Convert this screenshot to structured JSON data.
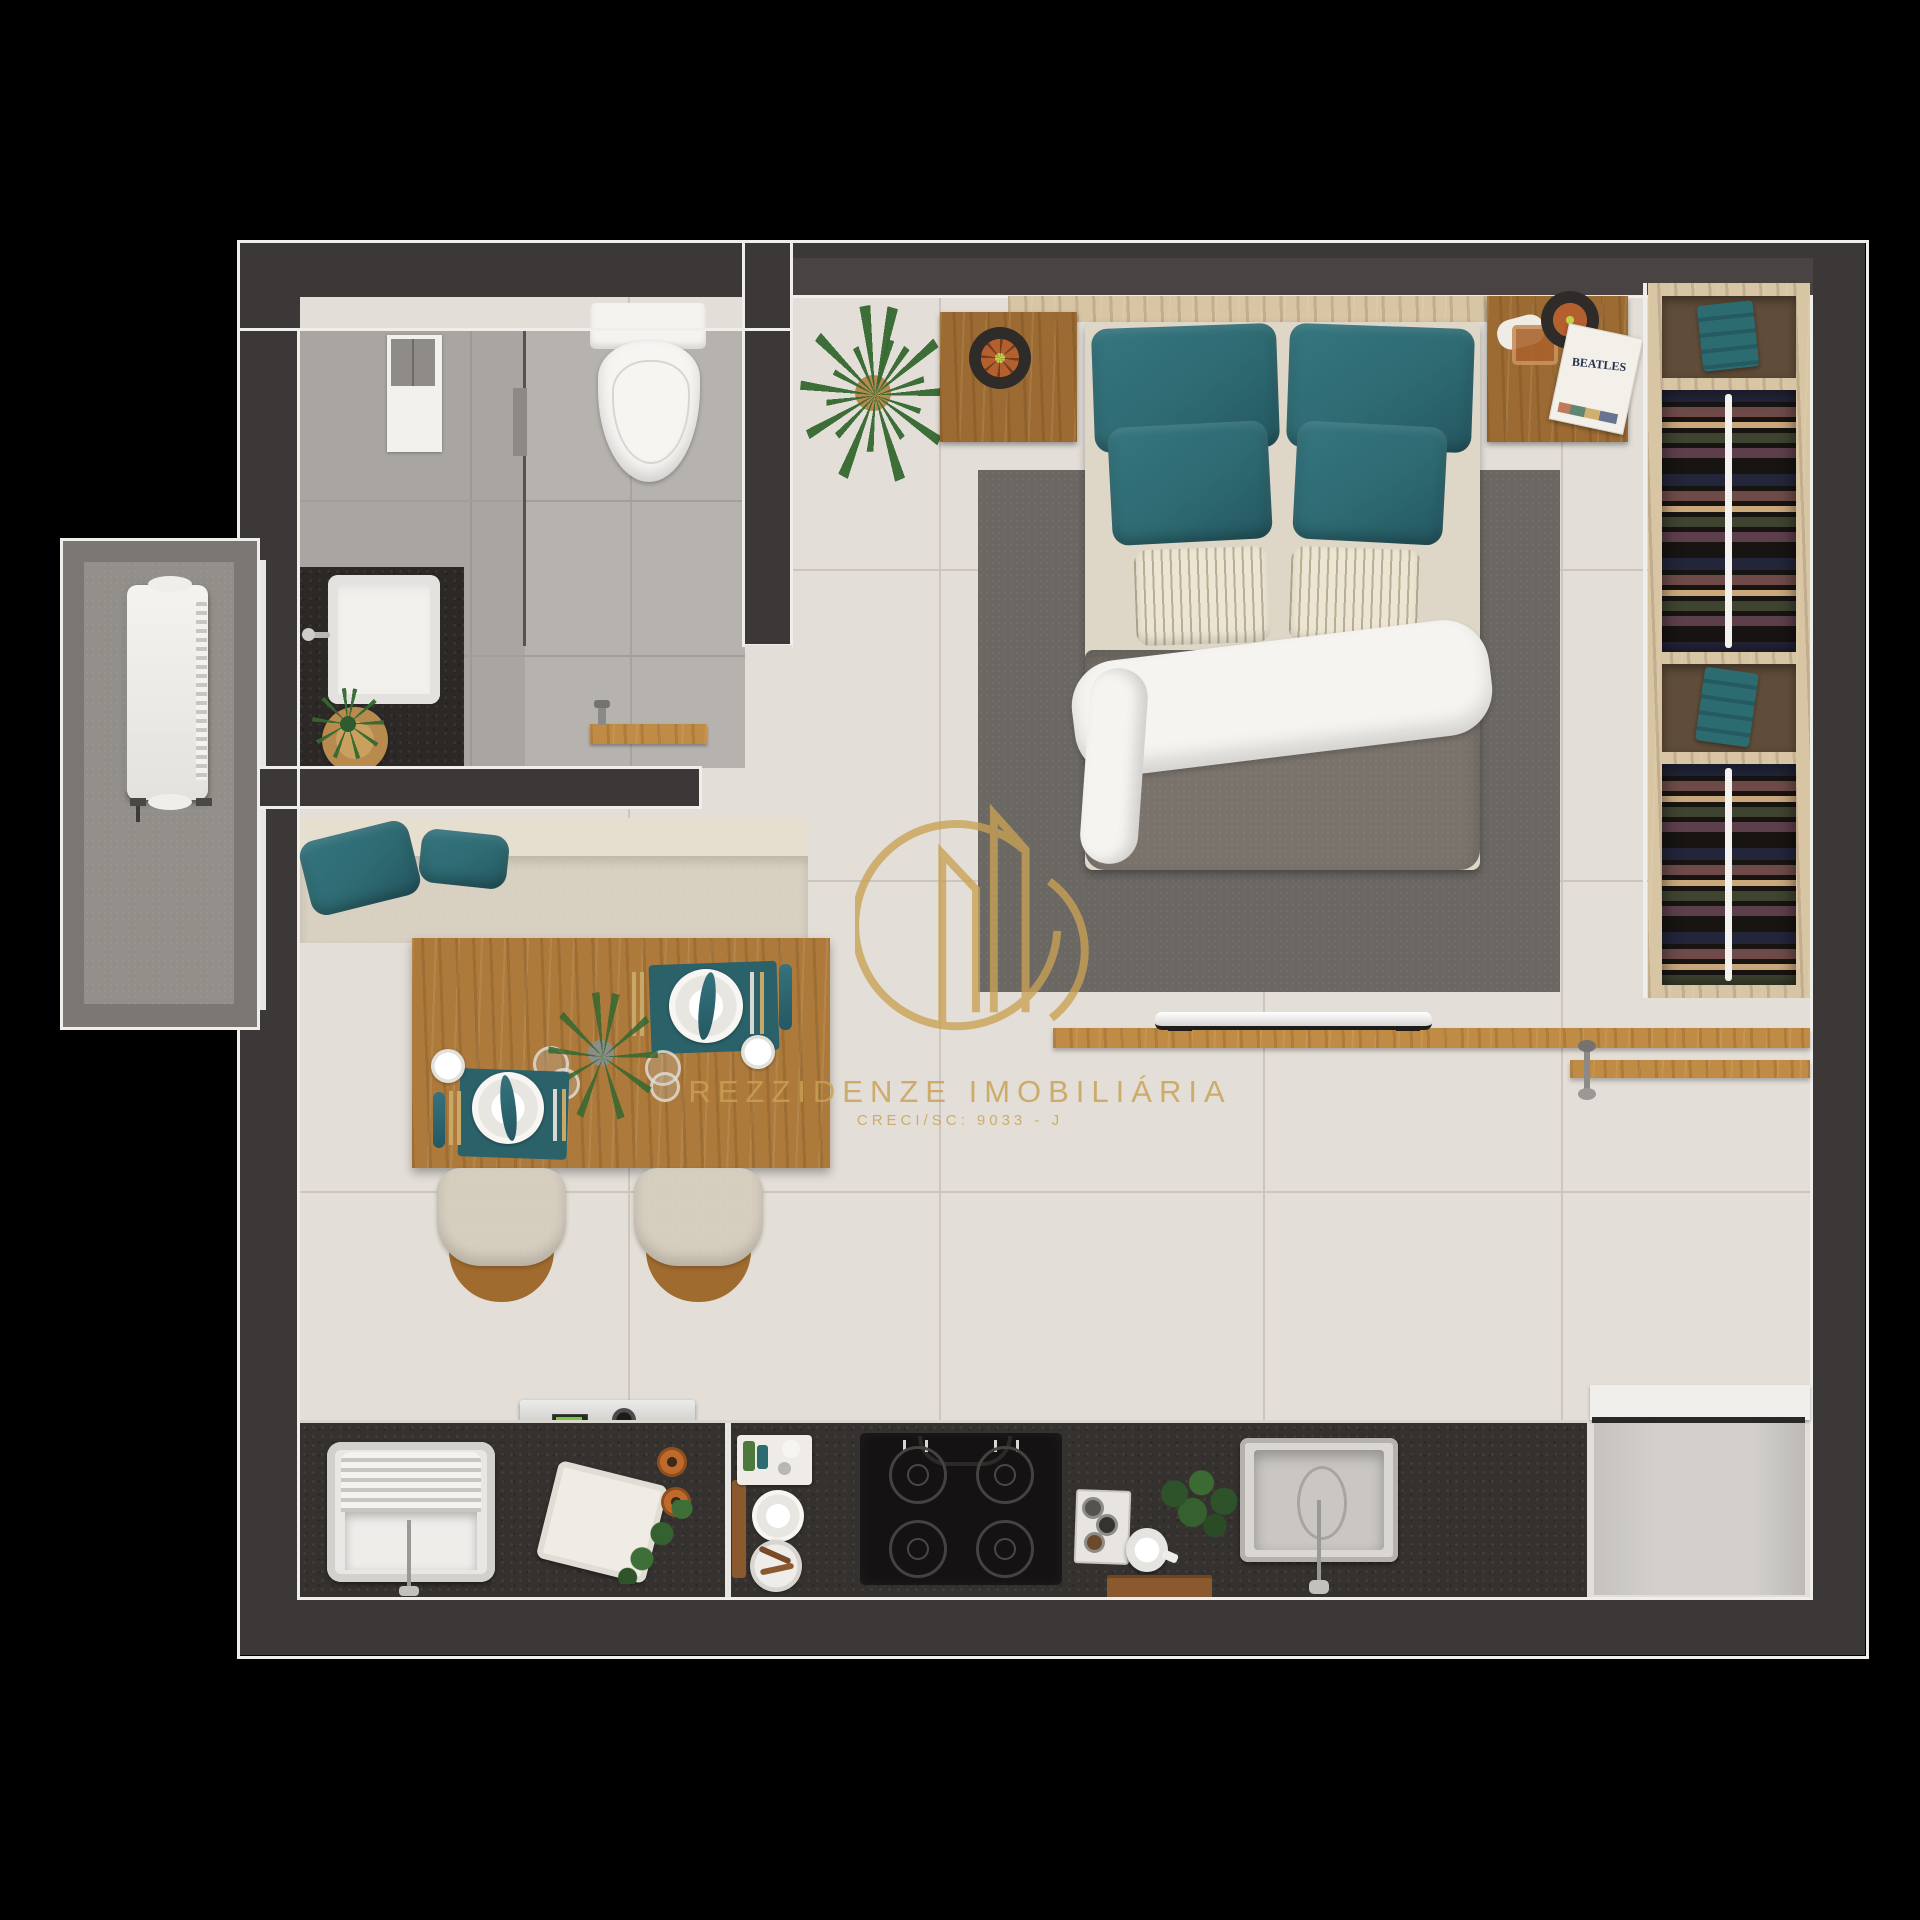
{
  "watermark": {
    "brand": "REZZIDENZE IMOBILIÁRIA",
    "license": "CRECI/SC: 9033 - J"
  },
  "decor": {
    "album_title": "BEATLES"
  },
  "colors": {
    "background": "#000000",
    "wall": "#3c3838",
    "wall_inner": "#494443",
    "trim": "#f0eeea",
    "floor": "#e3ded7",
    "grout": "#ccc6be",
    "bath_floor": "#b6b2ae",
    "shower_floor": "#a9a5a1",
    "counter": "#35312e",
    "rug": "#6b6763",
    "duvet": "#7a736c",
    "mattress": "#ded7c7",
    "sheet": "#f6f4f0",
    "teal": "#2e6a72",
    "sofa": "#d8d0c1",
    "wood_table": "#ad7a3c",
    "wood_light": "#d8c5a4",
    "wood_mid": "#c08b45",
    "wood_dark": "#9c6b33",
    "gold": "#c9a254",
    "fridge": "#d3d0cc",
    "ac_slab": "#928e89",
    "green": "#3c713a",
    "white_goods": "#f1efec"
  }
}
